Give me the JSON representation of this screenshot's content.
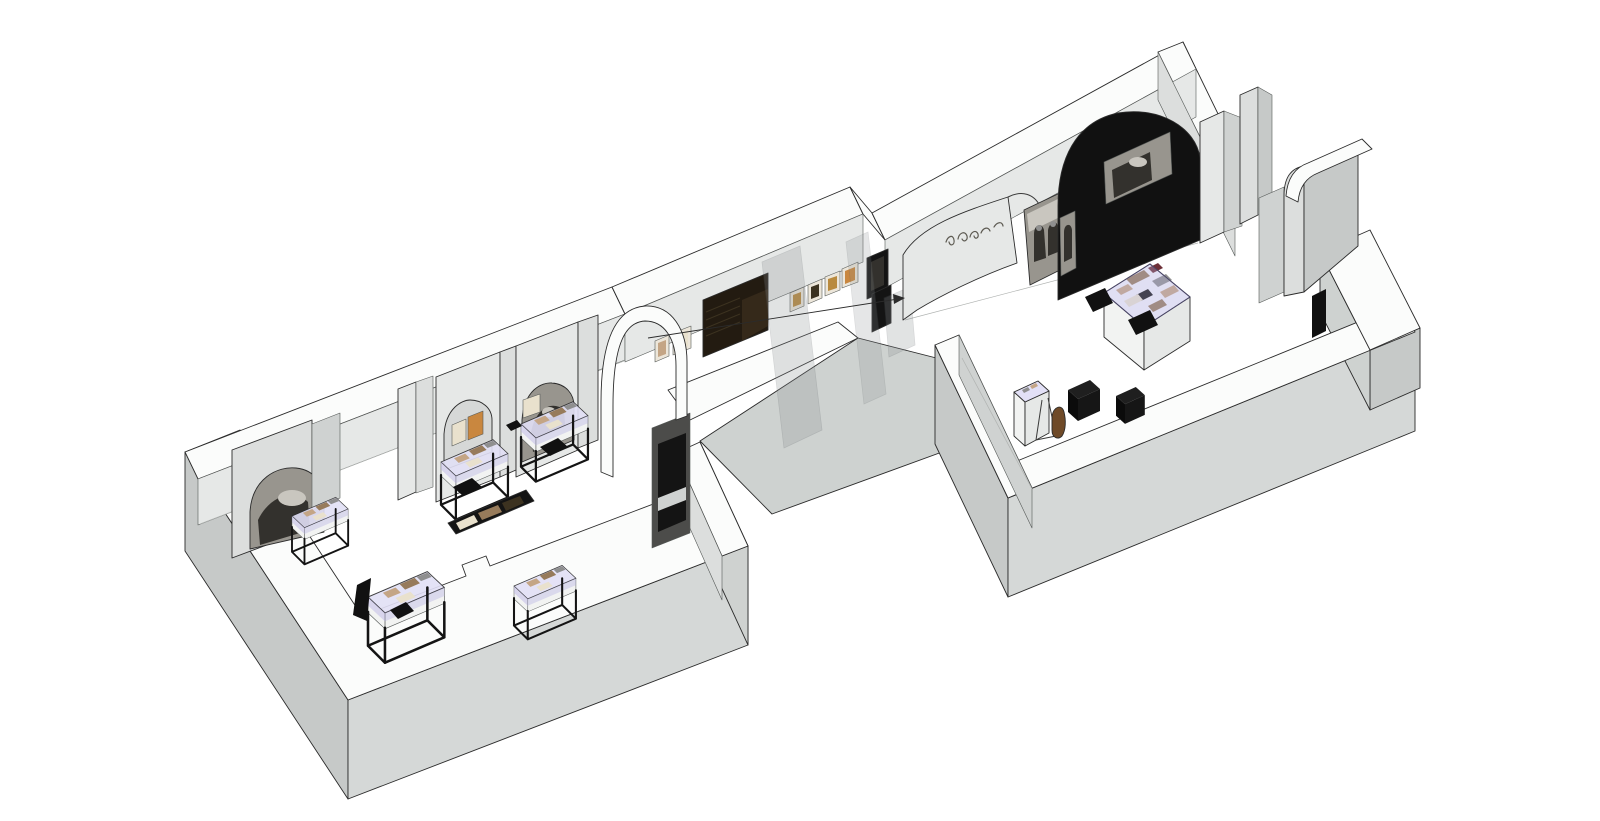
{
  "meta": {
    "description": "Axonometric cutaway 3D rendering of a two-gallery museum exhibition floor plan on a white background",
    "view": "3D cutaway overview",
    "visible_text": "none (only an illegible calligraphic signage squiggle on the entry wall)"
  },
  "palette": {
    "background": "#ffffff",
    "wallTop": "#fbfcfb",
    "outline": "#2b2b2b",
    "extLight": "#d5d8d7",
    "extMid": "#c6c9c8",
    "extRamp": "#ced2d0",
    "intLight": "#e6e8e7",
    "intMid": "#dcdedd",
    "intDark": "#cfd2d1",
    "niche": "#d6d8d7",
    "reveal": "#4c4c4a",
    "glassTint": "#b7b2e4",
    "glassTop": "#e2e0f6",
    "caseWhite": "#f2f3f2",
    "frameBlack": "#141414",
    "panelDark": "#231b11",
    "slat": "#3c3220",
    "gold": "#b98a3e",
    "mat": "#ece6da",
    "beige": "#e9e1cd",
    "orange": "#c9873f",
    "photoBase": "#98958e",
    "photoDark": "#33312d",
    "photoLight": "#c9c6bf",
    "black": "#111111",
    "tan": "#c4a585",
    "brown": "#977b5b",
    "darkRed": "#6e3038",
    "midGray": "#8f8f8f",
    "figBrown": "#6f4a28",
    "paleGap": "#cfd2d0"
  },
  "scene": {
    "left_gallery": {
      "label": "left exhibition gallery",
      "display_cases": 5,
      "wall_arches": 3,
      "photo_murals": 2,
      "framed_documents": 3,
      "floor_display_strip": 1,
      "floor_cushions": 4
    },
    "corridor": {
      "label": "connecting corridor",
      "wall_frames": 6,
      "dark_display_panel": 1,
      "dark_wall_frames": 2,
      "glass_partitions": 3,
      "annotation_arrow": 1
    },
    "right_gallery": {
      "label": "right exhibition gallery",
      "entry_script_wall": 1,
      "freestanding_photo_panel": 1,
      "black_arch_wall": 1,
      "photo_insets": 2,
      "display_table": 1,
      "cube_vitrine": 1,
      "black_seat_cubes": 2,
      "figure_sculpture": 1,
      "curved_baffle_wall": 1
    }
  }
}
